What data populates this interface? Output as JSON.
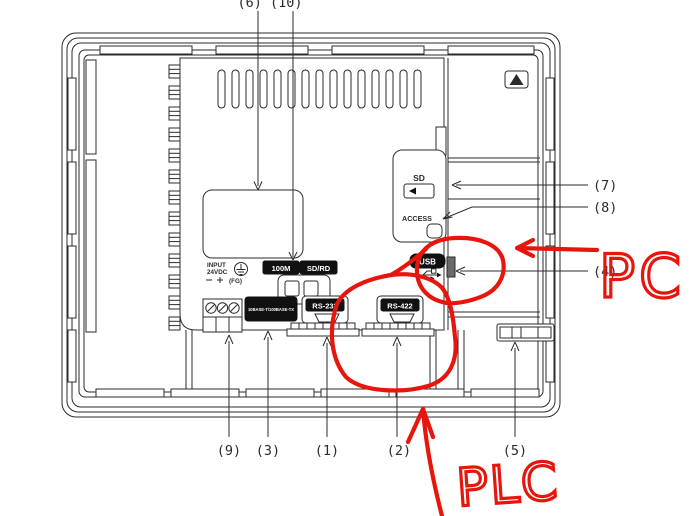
{
  "callouts": {
    "top": "(6) (10)",
    "c1": "(1)",
    "c2": "(2)",
    "c3": "(3)",
    "c4": "(4)",
    "c5": "(5)",
    "c7": "(7)",
    "c8": "(8)",
    "c9": "(9)"
  },
  "ports": {
    "sd": "SD",
    "access": "ACCESS",
    "usb": "USB",
    "rs232": "RS-232",
    "rs422": "RS-422",
    "ethernet": "10BASE-T/100BASE-TX"
  },
  "leds": {
    "eth_speed": "100M",
    "eth_sdrd": "SD/RD"
  },
  "power": {
    "input": "INPUT",
    "voltage": "24VDC",
    "fg": "(FG)"
  },
  "annotations": {
    "pc": "PC",
    "plc": "PLC"
  },
  "colors": {
    "annotation_red": "#e8150d",
    "line": "#2b2b2b",
    "label_bg": "#111111"
  }
}
